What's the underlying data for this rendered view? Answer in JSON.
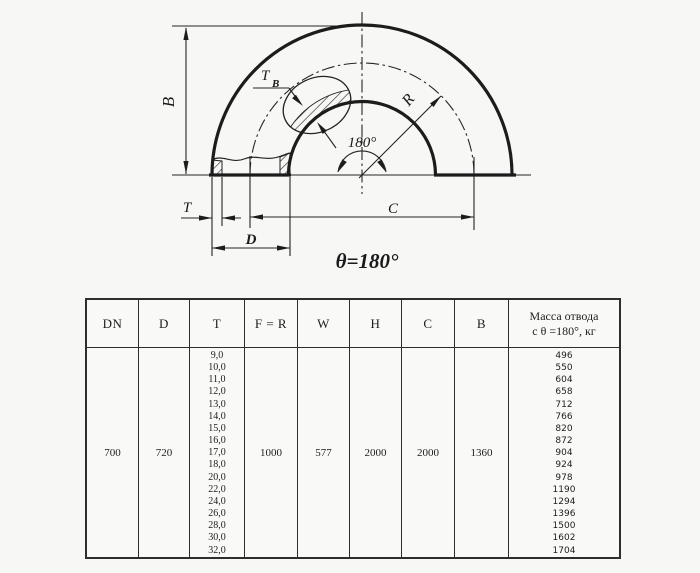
{
  "diagram": {
    "dim_b": "B",
    "dim_tb_t": "T",
    "dim_tb_sub": "B",
    "dim_r": "R",
    "angle_label": "180°",
    "dim_t": "T",
    "dim_d": "D",
    "dim_c": "C",
    "theta_label": "θ=180°"
  },
  "table": {
    "headers": [
      "DN",
      "D",
      "T",
      "F = R",
      "W",
      "H",
      "C",
      "B"
    ],
    "mass_header": [
      "Масса отвода",
      "с θ =180°, кг"
    ],
    "row": {
      "dn": "700",
      "d": "720",
      "f_r": "1000",
      "w": "577",
      "h": "2000",
      "c": "2000",
      "b": "1360",
      "t_values": [
        "9,0",
        "10,0",
        "11,0",
        "12,0",
        "13,0",
        "14,0",
        "15,0",
        "16,0",
        "17,0",
        "18,0",
        "20,0",
        "22,0",
        "24,0",
        "26,0",
        "28,0",
        "30,0",
        "32,0"
      ],
      "mass_values": [
        "496",
        "550",
        "604",
        "658",
        "712",
        "766",
        "820",
        "872",
        "904",
        "924",
        "978",
        "1190",
        "1294",
        "1396",
        "1500",
        "1602",
        "1704"
      ]
    }
  }
}
